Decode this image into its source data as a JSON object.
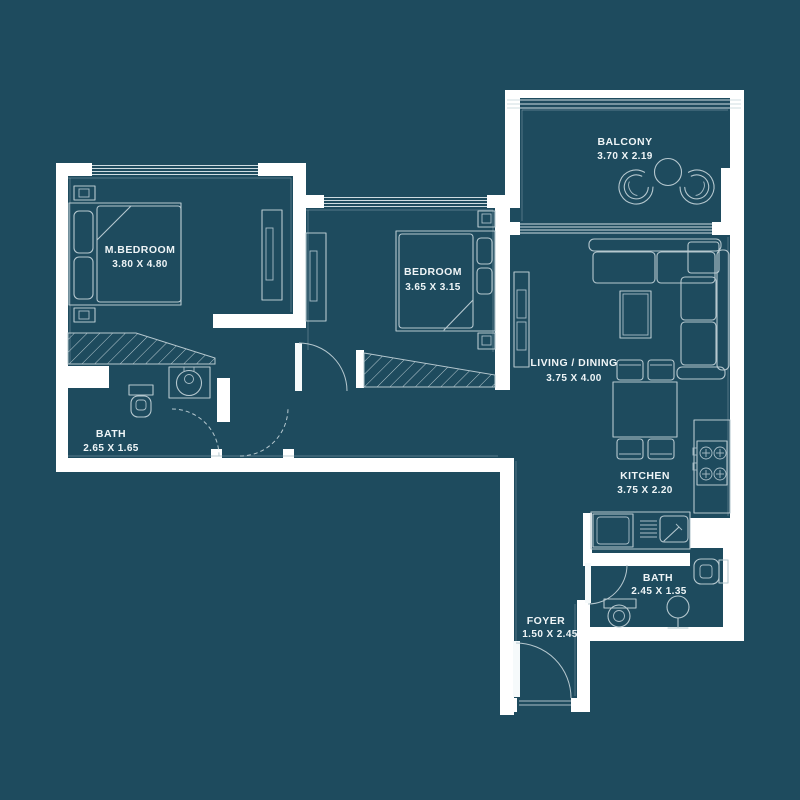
{
  "colors": {
    "background": "#1e4b5e",
    "walls": "#ffffff",
    "furniture_lines": "#b6c8cf",
    "label_text": "#eff5f7"
  },
  "rooms": [
    {
      "id": "master-bedroom",
      "name": "M.BEDROOM",
      "dimensions": "3.80 X 4.80"
    },
    {
      "id": "bedroom",
      "name": "BEDROOM",
      "dimensions": "3.65 X 3.15"
    },
    {
      "id": "balcony",
      "name": "BALCONY",
      "dimensions": "3.70 X 2.19"
    },
    {
      "id": "living-dining",
      "name": "LIVING / DINING",
      "dimensions": "3.75 X 4.00"
    },
    {
      "id": "kitchen",
      "name": "KITCHEN",
      "dimensions": "3.75 X 2.20"
    },
    {
      "id": "bath-master",
      "name": "BATH",
      "dimensions": "2.65 X 1.65"
    },
    {
      "id": "bath-guest",
      "name": "BATH",
      "dimensions": "2.45 X 1.35"
    },
    {
      "id": "foyer",
      "name": "FOYER",
      "dimensions": "1.50 X 2.45"
    }
  ]
}
